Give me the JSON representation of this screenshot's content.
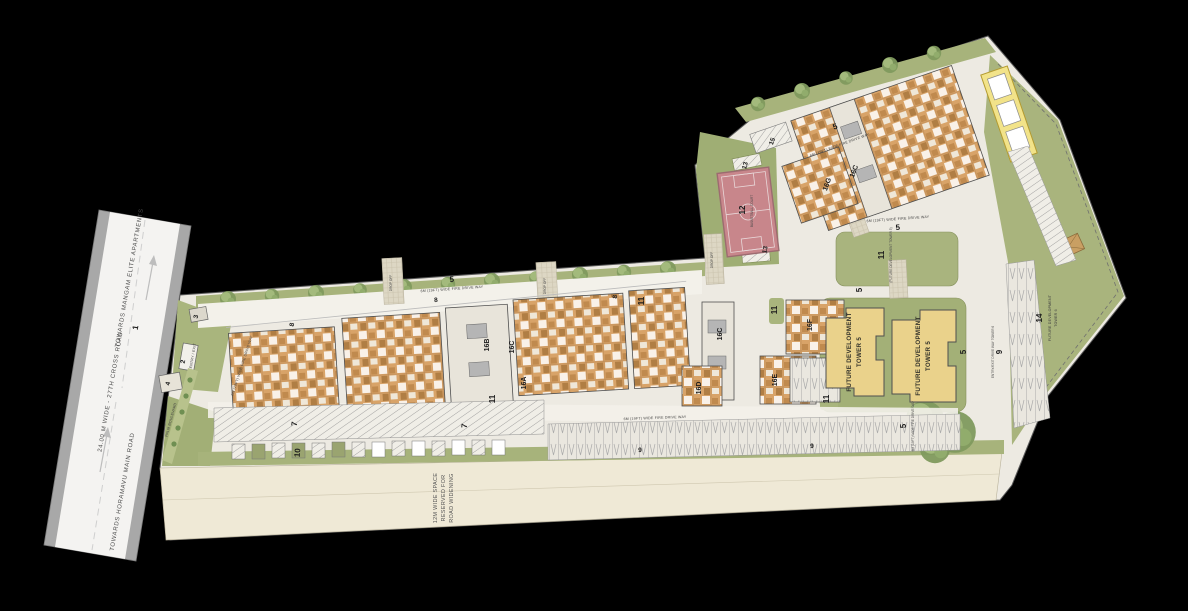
{
  "roads": {
    "towards_top": "TOWARDS MANGAM ELITE APARTMENTS",
    "left_road_name": "24.00 M WIDE - 27TH CROSS ROAD",
    "towards_bottom": "TOWARDS HORAMAVU MAIN ROAD",
    "fire_drive_way": "6M (19FT) WIDE FIRE DRIVE WAY",
    "road_widening_1": "12M WIDE SPACE",
    "road_widening_2": "RESERVED FOR",
    "road_widening_3": "ROAD WIDENING",
    "palm_path": "PALM BOULEVARD",
    "drop_off": "DROP OFF",
    "entry_exit": "ENTRY / EXIT",
    "tower6_drive": "ENTRY/EXIT DRIVE WAY TOWER 6"
  },
  "markers": {
    "m1": "1",
    "m2": "2",
    "m3": "3",
    "m4": "4",
    "m5": "5",
    "m7": "7",
    "m8": "8",
    "m9": "9",
    "m10": "10",
    "m11": "11",
    "m12": "12",
    "m13": "13",
    "m14": "14",
    "m15": "15"
  },
  "towers": {
    "t16a": "16A",
    "t16b": "16B",
    "t16c": "16C",
    "t16d": "16D",
    "t16e": "16E",
    "t16f": "16F",
    "t16g": "16G"
  },
  "future": {
    "t5_line1": "FUTURE DEVELOPMENT",
    "t5_line2": "TOWER 5",
    "t6_line1": "FUTURE DEVELOPMENT",
    "t6_line2": "TOWER 6",
    "lawn_note": "(FUTURE DEVELOPMENT TOWER 5)"
  },
  "court": {
    "name": "BASKETBALL COURT"
  },
  "colors": {
    "site_green": "#a7b37b",
    "paving": "#edeae2",
    "building_tan": "#d8a368",
    "future_yellow": "#ead28b",
    "court_red": "#c8868b",
    "road_gray": "#a8a8a8",
    "reserve_beige": "#efe9d6",
    "background": "#000000"
  }
}
